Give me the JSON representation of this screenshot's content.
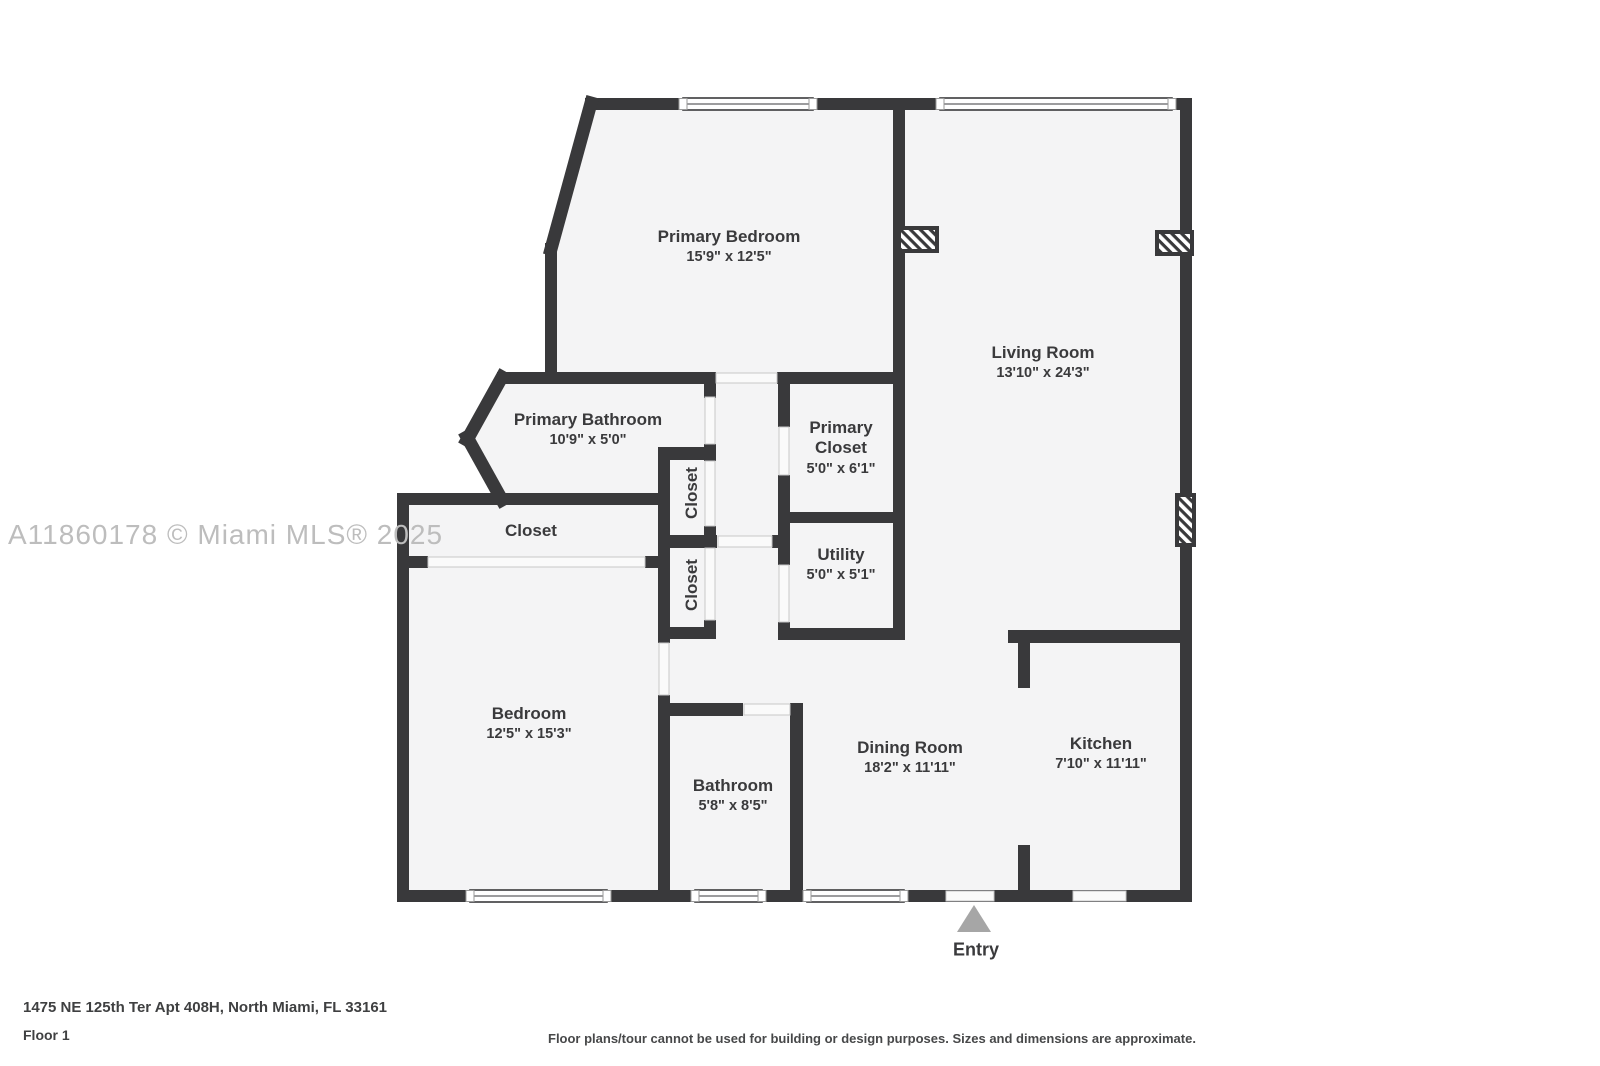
{
  "watermark": "A11860178 © Miami MLS® 2025",
  "rooms": [
    {
      "id": "primary-bedroom",
      "name": "Primary Bedroom",
      "dims": "15'9\" x 12'5\""
    },
    {
      "id": "living-room",
      "name": "Living Room",
      "dims": "13'10\" x 24'3\""
    },
    {
      "id": "primary-bathroom",
      "name": "Primary Bathroom",
      "dims": "10'9\" x 5'0\""
    },
    {
      "id": "primary-closet",
      "name": "Primary Closet",
      "dims": "5'0\" x 6'1\""
    },
    {
      "id": "utility",
      "name": "Utility",
      "dims": "5'0\" x 5'1\""
    },
    {
      "id": "hall-closet",
      "name": "Closet",
      "dims": ""
    },
    {
      "id": "closet-upper",
      "name": "Closet",
      "dims": ""
    },
    {
      "id": "closet-lower",
      "name": "Closet",
      "dims": ""
    },
    {
      "id": "bedroom",
      "name": "Bedroom",
      "dims": "12'5\" x 15'3\""
    },
    {
      "id": "bathroom",
      "name": "Bathroom",
      "dims": "5'8\" x 8'5\""
    },
    {
      "id": "dining-room",
      "name": "Dining Room",
      "dims": "18'2\" x 11'11\""
    },
    {
      "id": "kitchen",
      "name": "Kitchen",
      "dims": "7'10\" x 11'11\""
    }
  ],
  "entry": {
    "label": "Entry"
  },
  "footer": {
    "address": "1475 NE 125th Ter Apt 408H, North Miami, FL 33161",
    "floor": "Floor 1",
    "disclaimer": "Floor plans/tour cannot be used for building or design purposes. Sizes and dimensions are approximate."
  },
  "colors": {
    "wall": "#39393b",
    "floor_fill": "#f4f4f5",
    "text": "#3a3a3c",
    "watermark": "#bdbdbd",
    "entry_arrow": "#a6a6a6",
    "opening_line": "#c8c8c8"
  }
}
